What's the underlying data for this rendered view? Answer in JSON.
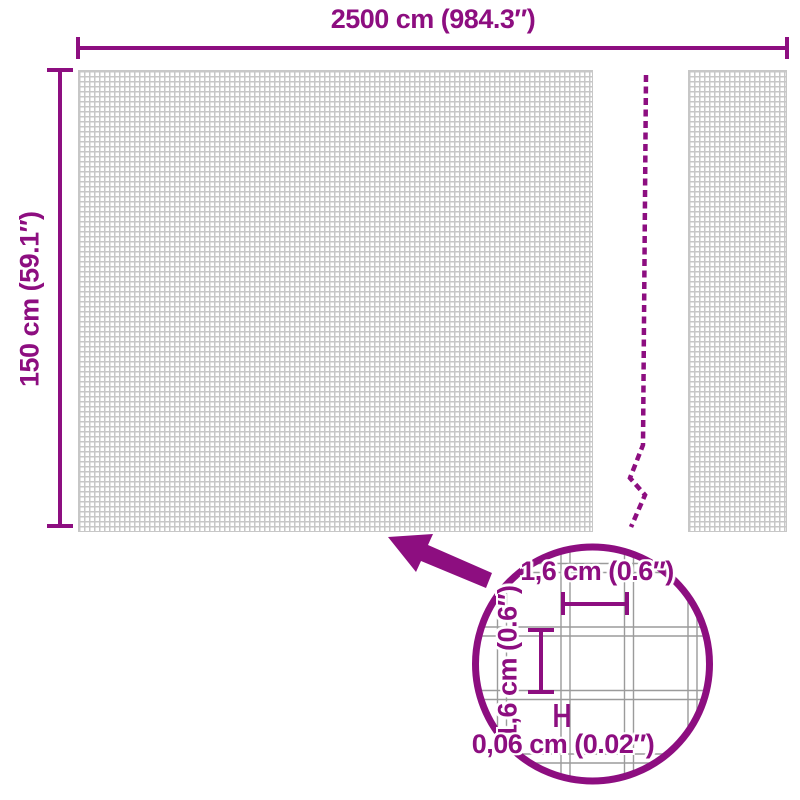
{
  "diagram": {
    "width_label": "2500 cm (984.3″)",
    "height_label": "150 cm (59.1″)",
    "detail": {
      "cell_width_label": "1,6 cm (0.6″)",
      "cell_height_label": "1,6 cm (0.6″)",
      "wire_thickness_label": "0,06 cm (0.02″)"
    },
    "colors": {
      "accent": "#8D0E80",
      "mesh_line": "#C7C7C7",
      "wire_line": "#9B9B9B",
      "background": "#FFFFFF"
    }
  }
}
